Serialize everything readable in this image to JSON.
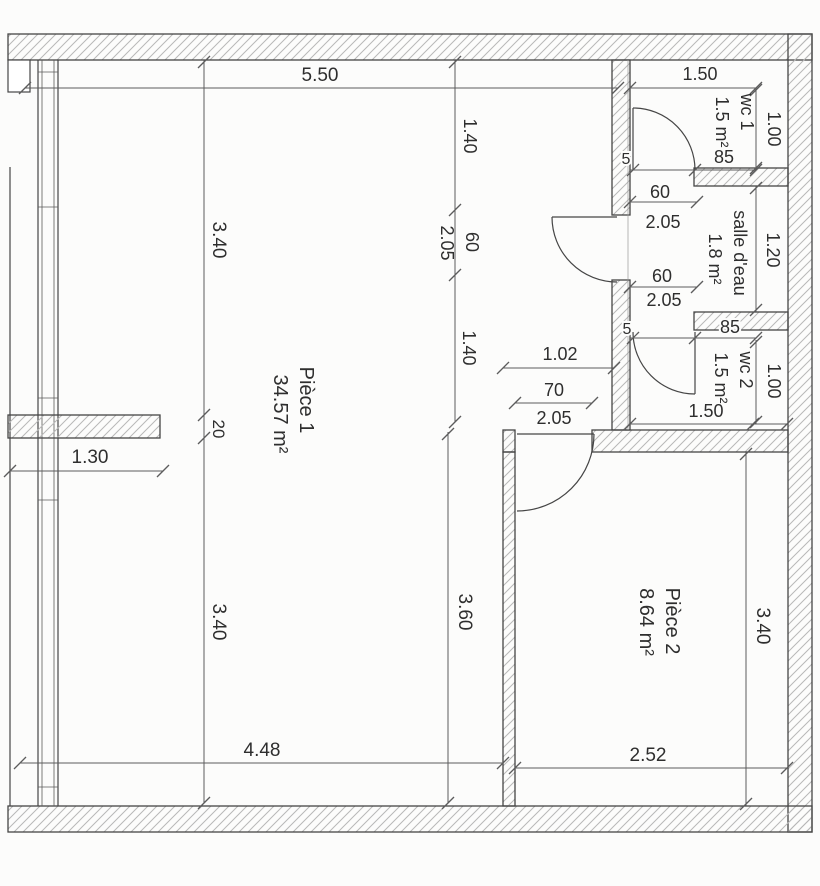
{
  "rooms": {
    "piece1": {
      "name": "Pièce 1",
      "area": "34.57 m²"
    },
    "piece2": {
      "name": "Pièce 2",
      "area": "8.64 m²"
    },
    "wc1": {
      "name": "wc 1",
      "area": "1.5 m²"
    },
    "salle_eau": {
      "name": "salle d'eau",
      "area": "1.8 m²"
    },
    "wc2": {
      "name": "wc 2",
      "area": "1.5 m²"
    }
  },
  "dims": {
    "top_width": "5.50",
    "wc1_width": "1.50",
    "wc1_depth": "1.00",
    "wc1_wall": "85",
    "wc1_jamb": "5",
    "sd_door_top_w": "60",
    "sd_door_top_h": "2.05",
    "sd_door_bot_w": "60",
    "sd_door_bot_h": "2.05",
    "sd_depth": "1.20",
    "wc2_jamb": "5",
    "wc2_wall": "85",
    "wc2_depth": "1.00",
    "wc2_width": "1.50",
    "hall_width": "1.02",
    "p2_door_w": "70",
    "p2_door_h": "2.05",
    "left_upper": "3.40",
    "stub_thickness": "20",
    "left_lower": "3.40",
    "recess_width": "1.30",
    "col_upper": "1.40",
    "col_door_h": "2.05",
    "col_door_w": "60",
    "col_lower": "1.40",
    "p1_inner_height": "3.60",
    "p2_right_height": "3.40",
    "p1_bottom_width": "4.48",
    "p2_bottom_width": "2.52"
  }
}
